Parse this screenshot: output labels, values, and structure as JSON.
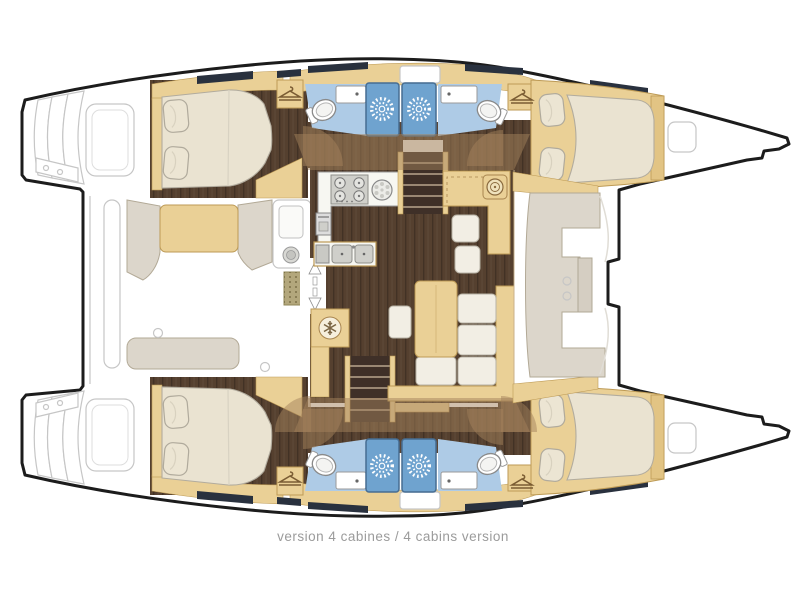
{
  "title": "Catamaran interior floor plan – 4 cabins version",
  "caption": {
    "text": "version 4 cabines / 4 cabins version"
  },
  "colors": {
    "hull-outline": "#1c1c1c",
    "cabinetry-beige": "#ead096",
    "cabinetry-border": "#bd9a55",
    "floor-wood": "#55402f",
    "mattress-cream": "#eae3d1",
    "bathroom-blue": "#aecbe6",
    "shower-blue": "#6fa3cf",
    "shower-border": "#476d92",
    "deck-gray": "#dcd6cb",
    "deck-line-gray": "#c6c6c6",
    "coachroof-tan": "rgba(164,130,92,0.5)",
    "grating-khaki": "#b3a77c",
    "counter-white": "#f7f7f2",
    "steel-gray": "#cfcfca",
    "window-navy": "#29313e",
    "caption-gray": "#9b9b9b",
    "background": "#ffffff"
  },
  "icons": {
    "shower-sun-icon": "white starburst shower drain",
    "fridge-snowflake-icon": "snowflake on cold box",
    "clothes-hanger-icon": "hanger in wardrobe locker",
    "door-slide-arrow-icon": "double arrow at saloon entry door",
    "stove-burners-icon": "4-burner cooktop",
    "toilet-icon": "toilet bowl",
    "sink-icon": "basin with drain dot",
    "bow-hatch-icon": "rounded deck hatch"
  }
}
